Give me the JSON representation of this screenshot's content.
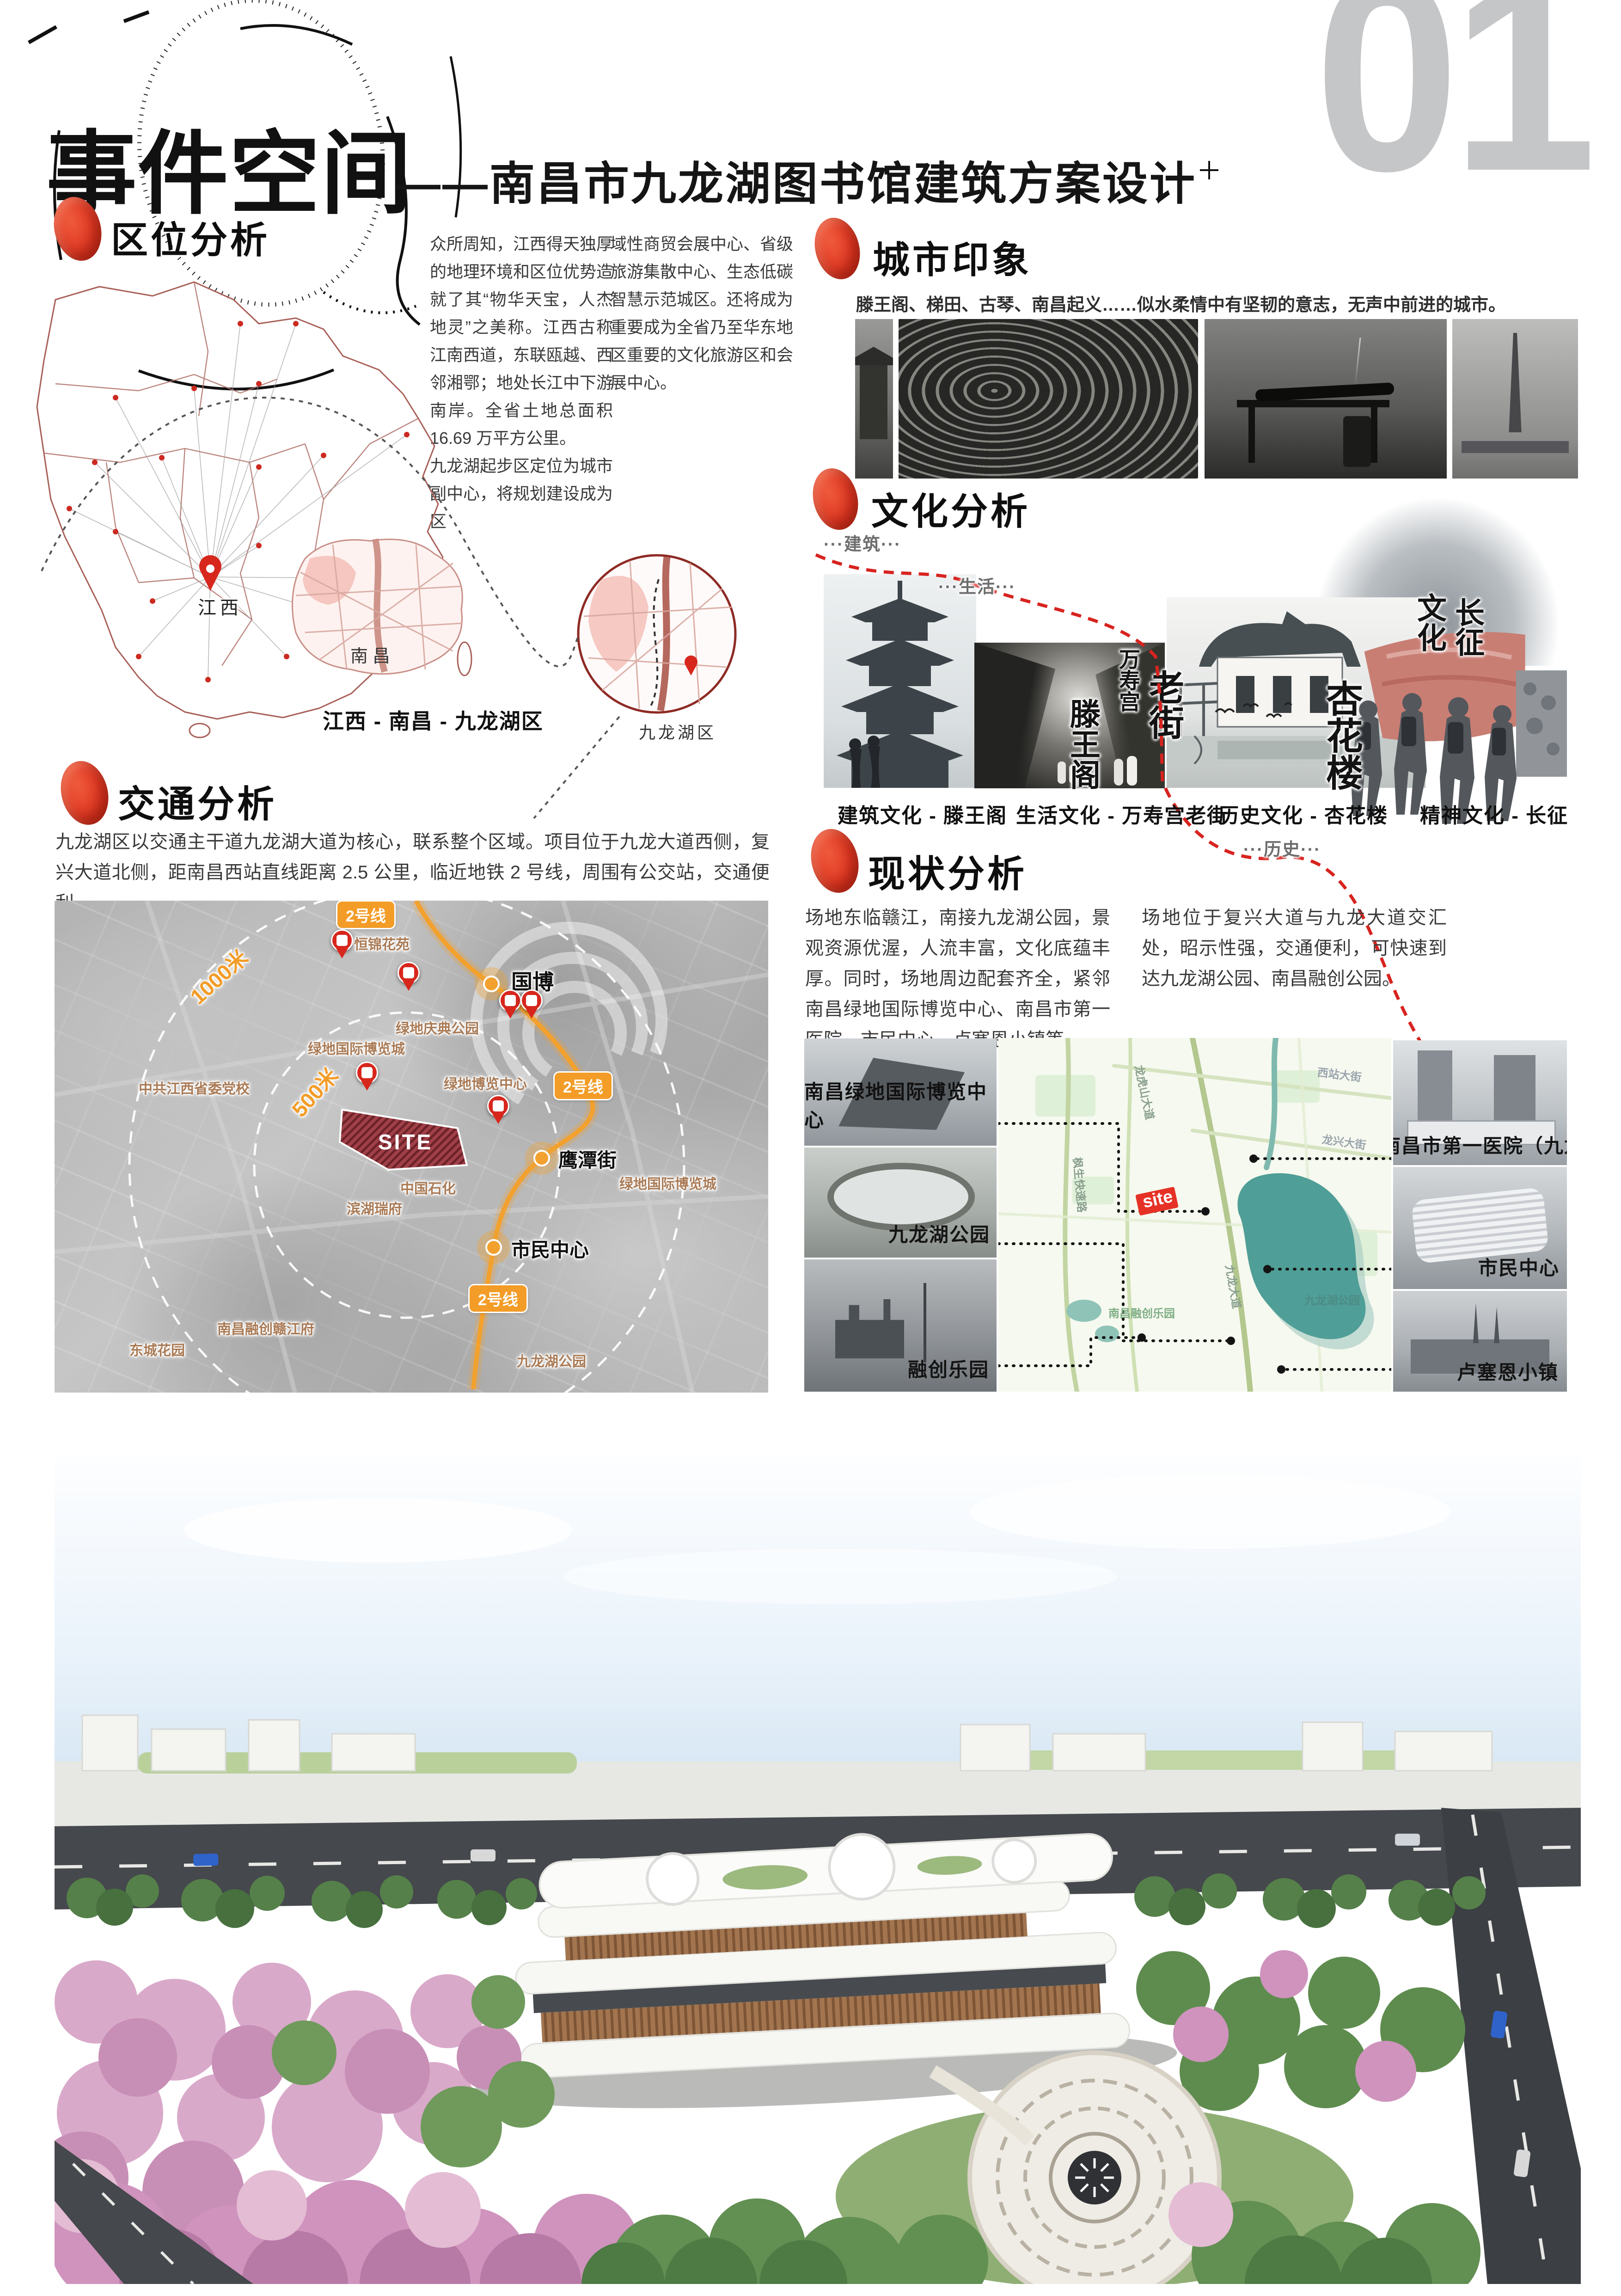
{
  "page": {
    "number": "01",
    "title": "事件空间",
    "subtitle": "——南昌市九龙湖图书馆建筑方案设计"
  },
  "location": {
    "heading": "区位分析",
    "col1": "众所周知，江西得天独厚的地理环境和区位优势造就了其“物华天宝，人杰地灵”之美称。江西古称江南西道，东联瓯越、西邻湘鄂；地处长江中下游南岸。全省土地总面积 16.69 万平方公里。\n九龙湖起步区定位为城市副中心，将规划建设成为区",
    "col2": "域性商贸会展中心、省级旅游集散中心、生态低碳智慧示范城区。还将成为重要成为全省乃至华东地区重要的文化旅游区和会展中心。",
    "province_label": "江西",
    "city_label": "南昌",
    "district_label": "九龙湖区",
    "caption": "江西 - 南昌 - 九龙湖区"
  },
  "impression": {
    "heading": "城市印象",
    "desc": "滕王阁、梯田、古琴、南昌起义……似水柔情中有坚韧的意志，无声中前进的城市。"
  },
  "culture": {
    "heading": "文化分析",
    "flow_labels": [
      "···建筑···",
      "···生活···",
      "···历史···"
    ],
    "calligraphy": {
      "pavilion": "滕王阁",
      "wanshou": "万寿宫",
      "laojie": "老街",
      "xinghua": "杏花楼",
      "wenhua": "文化",
      "changzheng": "长征"
    },
    "captions": [
      "建筑文化 - 滕王阁",
      "生活文化 - 万寿宫老街",
      "历史文化 - 杏花楼",
      "精神文化 - 长征"
    ]
  },
  "traffic": {
    "heading": "交通分析",
    "para": "九龙湖区以交通主干道九龙湖大道为核心，联系整个区域。项目位于九龙大道西侧，复兴大道北侧，距南昌西站直线距离 2.5 公里，临近地铁 2 号线，周围有公交站，交通便利。",
    "map": {
      "line_badge": "2号线",
      "stations": [
        "国博",
        "鹰潭街",
        "市民中心"
      ],
      "radius_500": "500米",
      "radius_1000": "1000米",
      "site": "SITE",
      "poi": [
        "恒锦花苑",
        "绿地庆典公园",
        "绿地国际博览城",
        "绿地博览中心",
        "中国石化",
        "滨湖瑞府",
        "绿地国际博览城",
        "中共江西省委党校",
        "东城花园",
        "南昌融创赣江府",
        "九龙湖公园"
      ]
    }
  },
  "status": {
    "heading": "现状分析",
    "col1": "场地东临赣江，南接九龙湖公园，景观资源优渥，人流丰富，文化底蕴丰厚。同时，场地周边配套齐全，紧邻南昌绿地国际博览中心、南昌市第一医院、市民中心、卢塞恩小镇等。",
    "col2": "场地位于复兴大道与九龙大道交汇处，昭示性强，交通便利，可快速到达九龙湖公园、南昌融创公园。",
    "left_captions": [
      "南昌绿地国际博览中心",
      "九龙湖公园",
      "融创乐园"
    ],
    "right_captions": [
      "南昌市第一医院（九龙湖分院）",
      "市民中心",
      "卢塞恩小镇"
    ],
    "map": {
      "site": "site",
      "labels": [
        "枫生快速路",
        "龙虎山大道",
        "九龙大道",
        "西站大街",
        "龙兴大街",
        "九龙湖公园",
        "南昌融创乐园"
      ]
    }
  }
}
